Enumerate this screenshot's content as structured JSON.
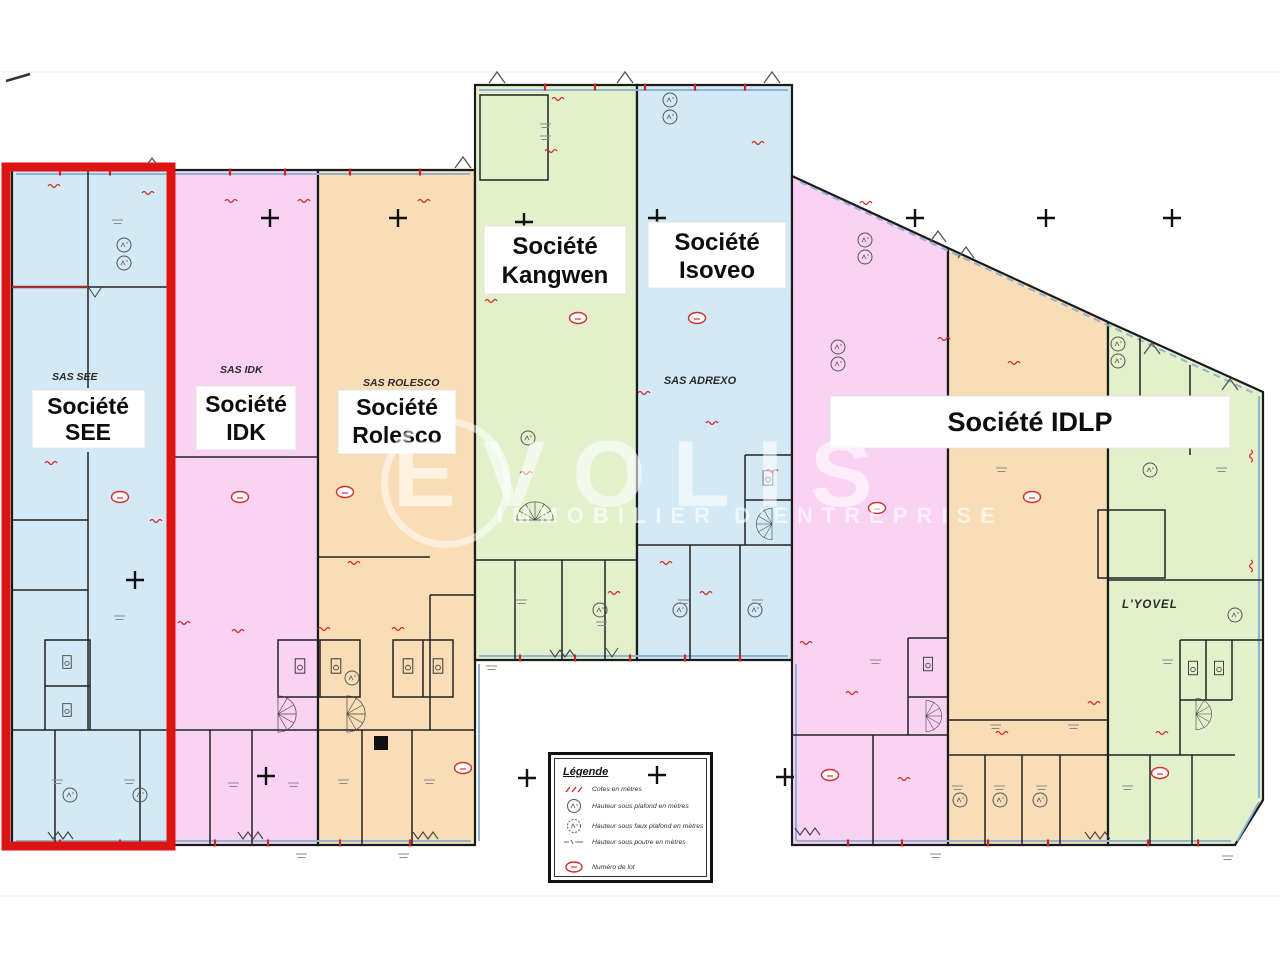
{
  "plan": {
    "watermark": {
      "brand": "EVOLIS",
      "tagline": "IMMOBILIER D'ENTREPRISE"
    },
    "labels": {
      "see_sas": "SAS SEE",
      "see_1": "Société",
      "see_2": "SEE",
      "idk_sas": "SAS IDK",
      "idk_1": "Société",
      "idk_2": "IDK",
      "rolesco_sas": "SAS ROLESCO",
      "rolesco_1": "Société",
      "rolesco_2": "Rolesco",
      "kangwen_1": "Société",
      "kangwen_2": "Kangwen",
      "isoveo_1": "Société",
      "isoveo_2": "Isoveo",
      "adrexo_sas": "SAS ADREXO",
      "idlp": "Société IDLP",
      "lyovel": "L'YOVEL"
    },
    "legend": {
      "title": "Légende",
      "items": [
        {
          "icon": "dimension-mark-icon",
          "label": "Cotes en mètres"
        },
        {
          "icon": "ceiling-height-icon",
          "label": "Hauteur sous plafond en mètres"
        },
        {
          "icon": "false-ceiling-height-icon",
          "label": "Hauteur sous faux plafond en mètres"
        },
        {
          "icon": "beam-height-icon",
          "label": "Hauteur sous poutre en mètres"
        },
        {
          "icon": "lot-number-icon",
          "label": "Numéro de lot"
        }
      ]
    },
    "colors": {
      "zone_blue": "#d3e9f5",
      "zone_pink": "#fad2f3",
      "zone_orange": "#f9ddb6",
      "zone_green": "#e2f1cc",
      "highlight_red": "#dd1414",
      "wall": "#1b1b1b",
      "window_blue": "#8fb3d1",
      "dimension_red": "#d22222"
    }
  }
}
